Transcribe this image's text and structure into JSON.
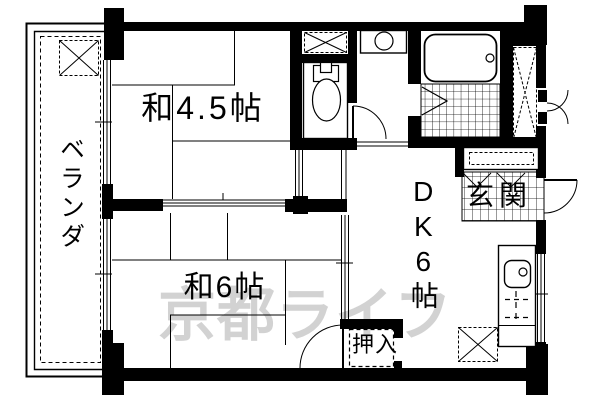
{
  "floorplan": {
    "background_color": "#ffffff",
    "wall_color": "#000000",
    "watermark": {
      "text": "京都ライフ",
      "color": "#d2d2d2"
    },
    "labels": {
      "veranda": "ベランダ",
      "japanese_room_45": "和4.5帖",
      "japanese_room_6": "和6帖",
      "dining_kitchen": "DK6帖",
      "entrance": "玄関",
      "closet": "押入"
    },
    "fixtures": [
      "bathtub-icon",
      "toilet-icon",
      "washbasin-icon",
      "kitchen-sink-icon",
      "washing-machine-space",
      "ac-unit-space",
      "refrigerator-space",
      "shoe-cabinet",
      "storage-unit",
      "entrance-door",
      "toilet-door",
      "bathroom-folding-door",
      "sliding-doors",
      "windows"
    ]
  }
}
